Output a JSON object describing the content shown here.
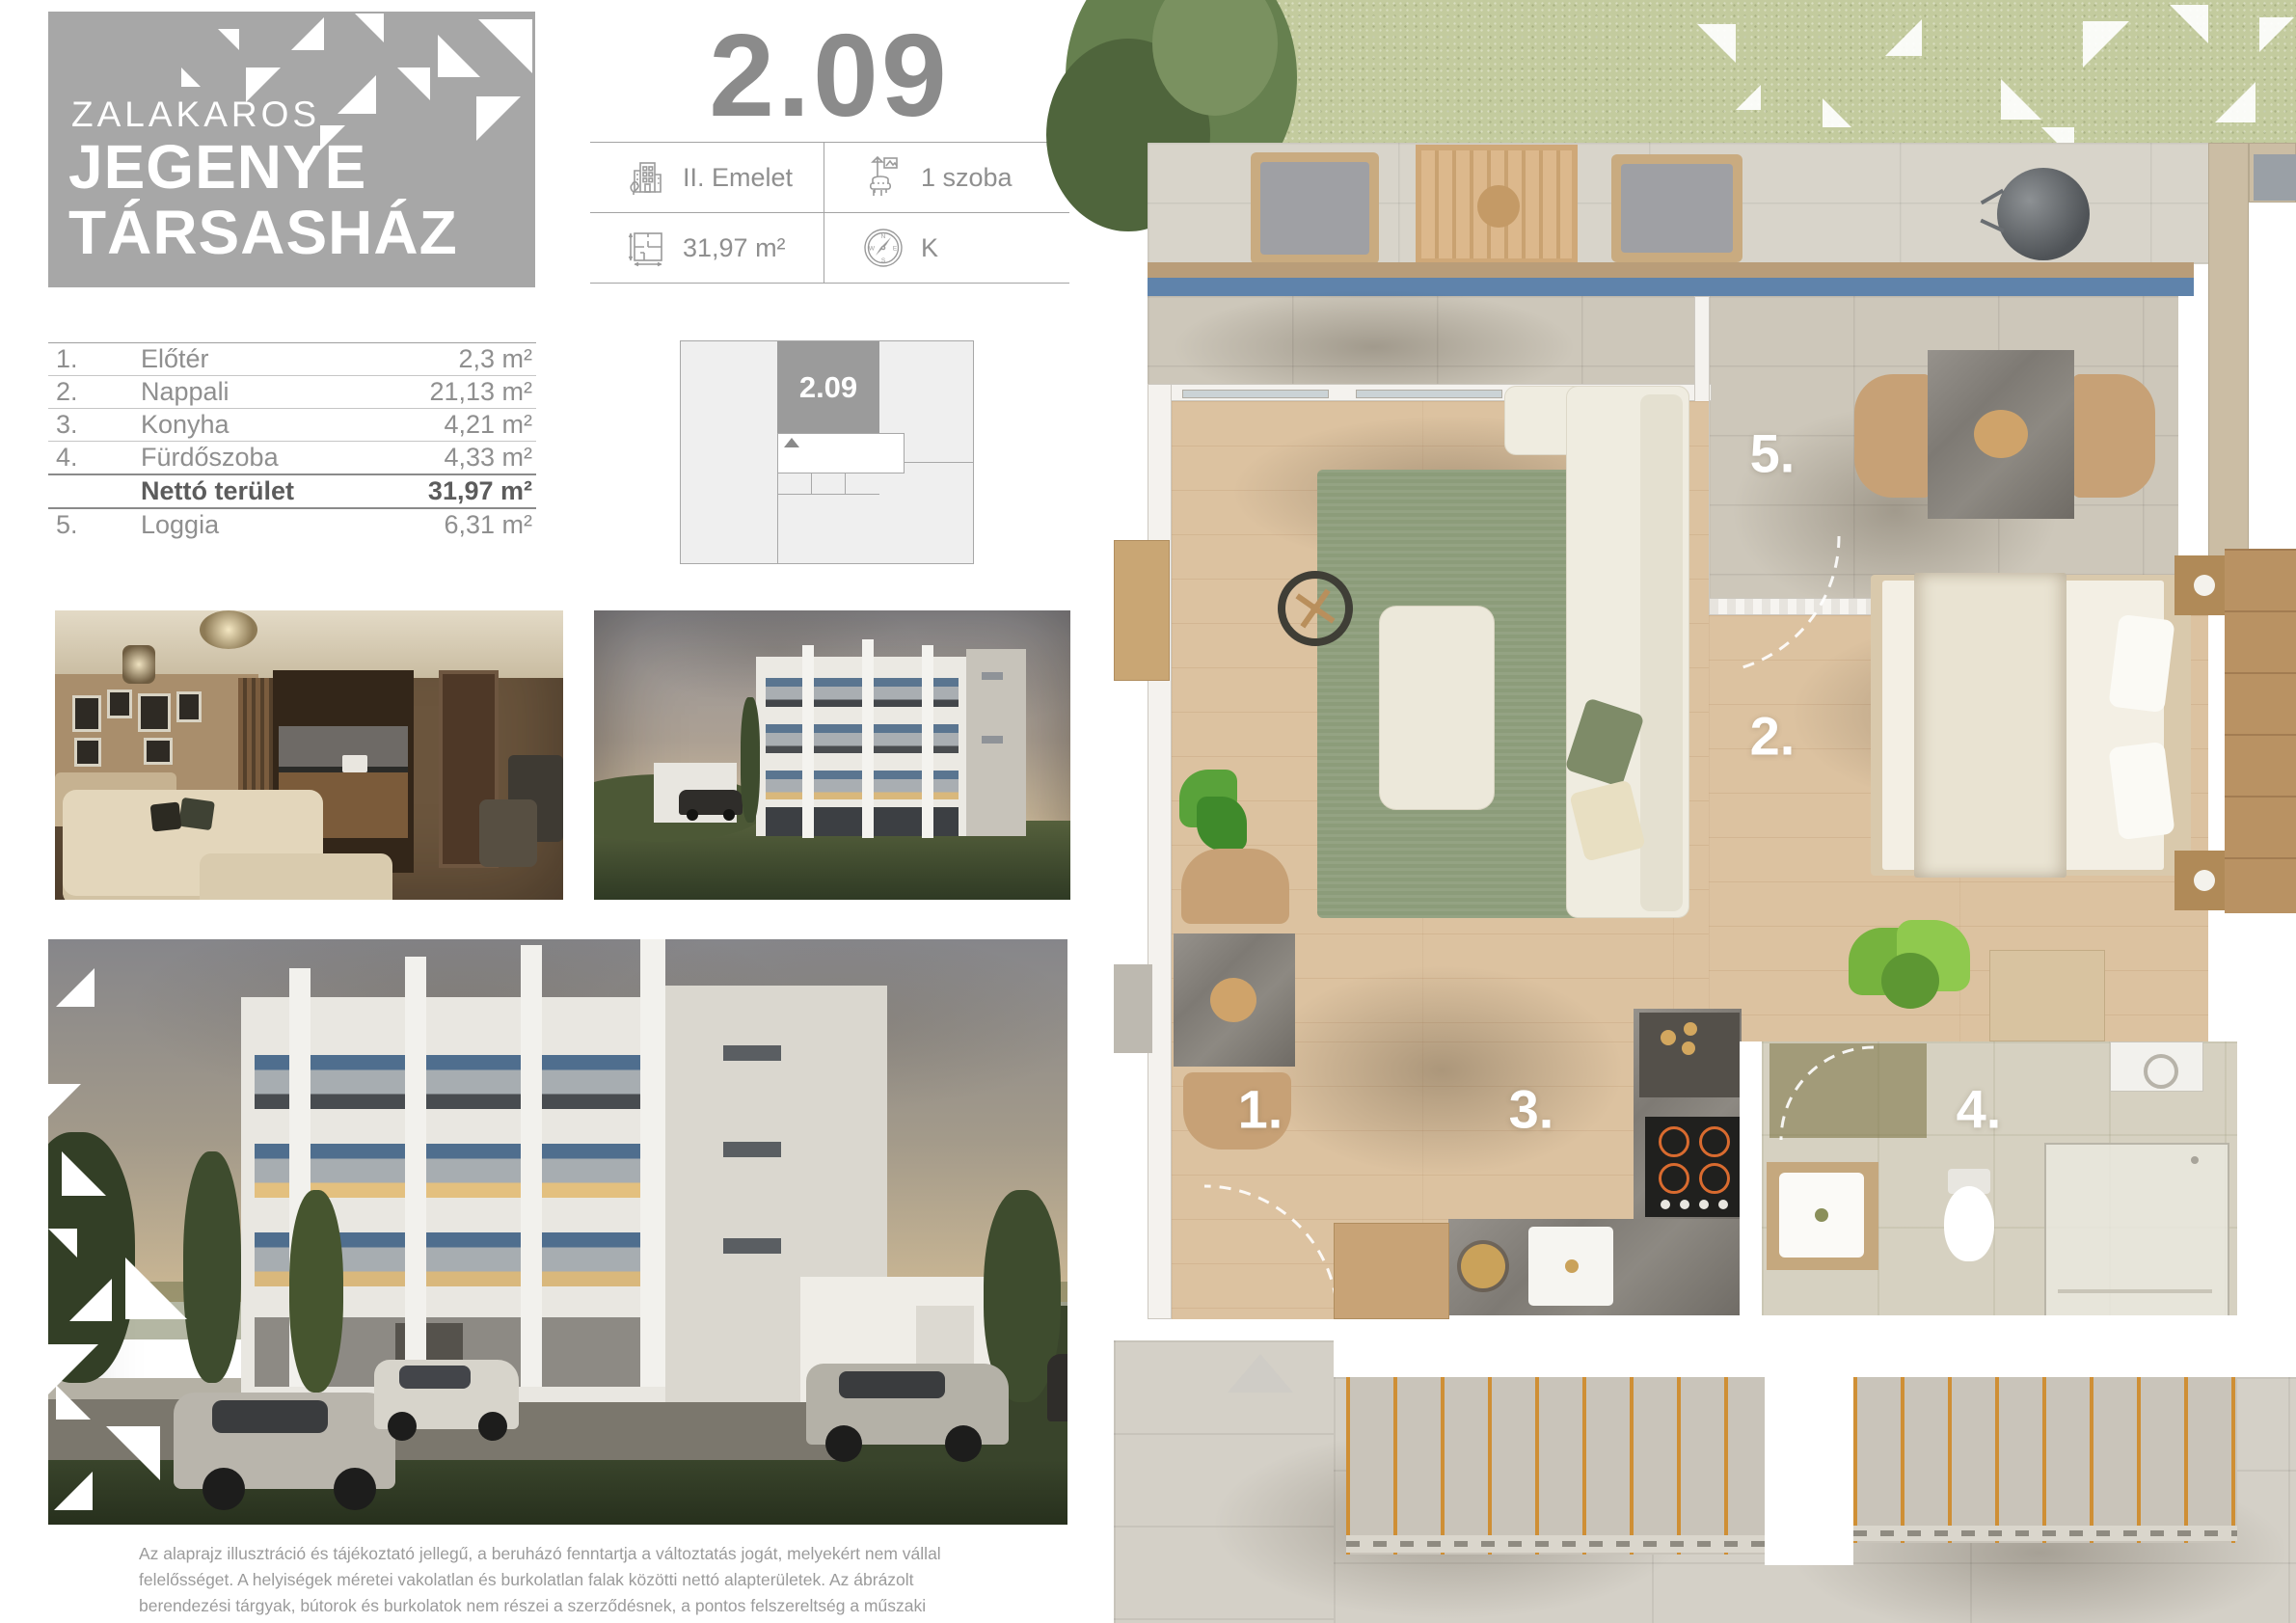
{
  "brand": {
    "location": "ZALAKAROS",
    "name_line1": "JEGENYE",
    "name_line2": "TÁRSASHÁZ"
  },
  "unit": {
    "number": "2.09"
  },
  "specs": {
    "floor": "II. Emelet",
    "rooms": "1 szoba",
    "area": "31,97 m²",
    "orientation": "K"
  },
  "room_table": {
    "rows": [
      {
        "num": "1.",
        "name": "Előtér",
        "area": "2,3 m²"
      },
      {
        "num": "2.",
        "name": "Nappali",
        "area": "21,13 m²"
      },
      {
        "num": "3.",
        "name": "Konyha",
        "area": "4,21 m²"
      },
      {
        "num": "4.",
        "name": "Fürdőszoba",
        "area": "4,33 m²"
      },
      {
        "num": "",
        "name": "Nettó terület",
        "area": "31,97 m²"
      },
      {
        "num": "5.",
        "name": "Loggia",
        "area": "6,31 m²"
      }
    ]
  },
  "key_plan": {
    "unit_label": "2.09"
  },
  "plan": {
    "labels": [
      "1.",
      "2.",
      "3.",
      "4.",
      "5."
    ]
  },
  "compass": {
    "n": "N",
    "e": "E",
    "s": "S",
    "w": "W"
  },
  "disclaimer": "Az alaprajz illusztráció és tájékoztató jellegű, a beruházó fenntartja a változtatás jogát, melyekért nem vállal felelősséget. A helyiségek méretei vakolatlan és burkolatlan falak közötti nettó alapterületek. Az ábrázolt berendezési tárgyak, bútorok és burkolatok nem részei a szerződésnek, a pontos felszereltség a műszaki leírásban található.",
  "colors": {
    "brand_gray": "#a7a7a7",
    "title_gray": "#8b8b8b",
    "accent_blue": "#5f83ab",
    "grass_green": "#c3cb9e",
    "rug_green": "#8c9c7a",
    "wood_floor": "#dcc2a0"
  }
}
